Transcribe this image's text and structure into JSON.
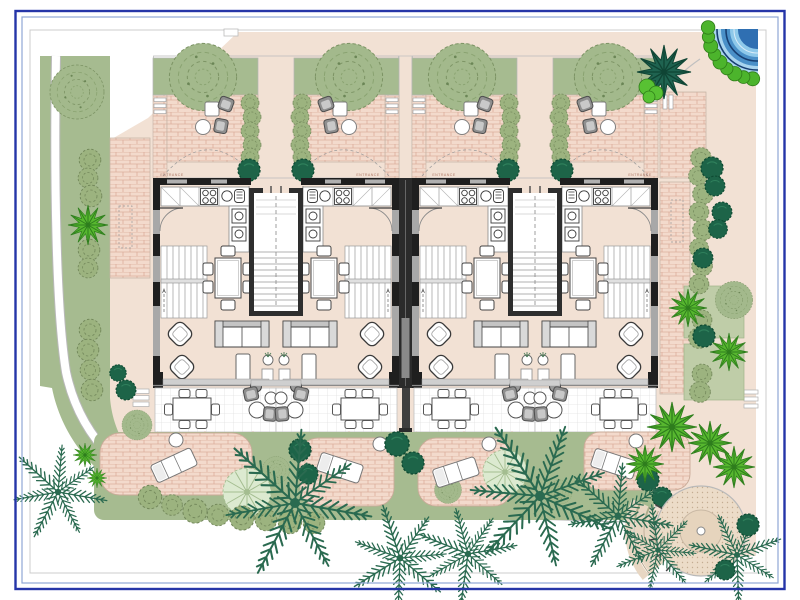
{
  "annotations": {
    "entrances": [
      "ENTRANCE",
      "ENTRANCE",
      "ENTRANCE",
      "ENTRANCE"
    ]
  },
  "site": {
    "units": [
      "unit-1",
      "unit-2",
      "unit-3",
      "unit-4"
    ],
    "amenities": [
      "corner-pool",
      "circular-plaza",
      "back-gardens",
      "front-terraces"
    ]
  },
  "palette": {
    "paper": "#ffffff",
    "frameNavy": "#2535a8",
    "frameSteel": "#8fa6d6",
    "sheetLine": "#cccccc",
    "paving": "#f2e1d4",
    "brick": "#f3dacc",
    "brickLine": "#dcae9c",
    "lawn": "#a6bb90",
    "lawnPale": "#bfcda8",
    "treeSage": "#a3b98c",
    "hedge": "#9cb37f",
    "shrubDark": "#1d6448",
    "fern": "#2a6a50",
    "palmBright": "#57b72f",
    "palmPale": "#dcead0",
    "poolLight": "#8ec9ea",
    "poolMid": "#4a90c8",
    "poolDark": "#173f72",
    "wall": "#1f1f1f",
    "furniture": "#9c9c9c",
    "entranceText": "#b07a68"
  }
}
